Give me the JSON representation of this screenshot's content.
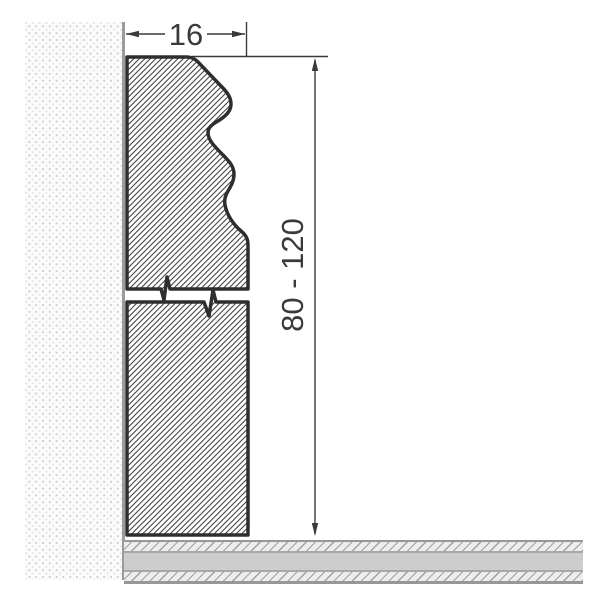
{
  "diagram": {
    "labels": {
      "width": "16",
      "height_range": "80 - 120"
    },
    "colors": {
      "profile_outline": "#2e2e2e",
      "dimension": "#3a3a3a",
      "wall_face_line": "#9b9b9b",
      "wall_stipple": "#cbcbcb",
      "floor_solid_band": "#cdcdcd",
      "background": "#ffffff"
    }
  }
}
